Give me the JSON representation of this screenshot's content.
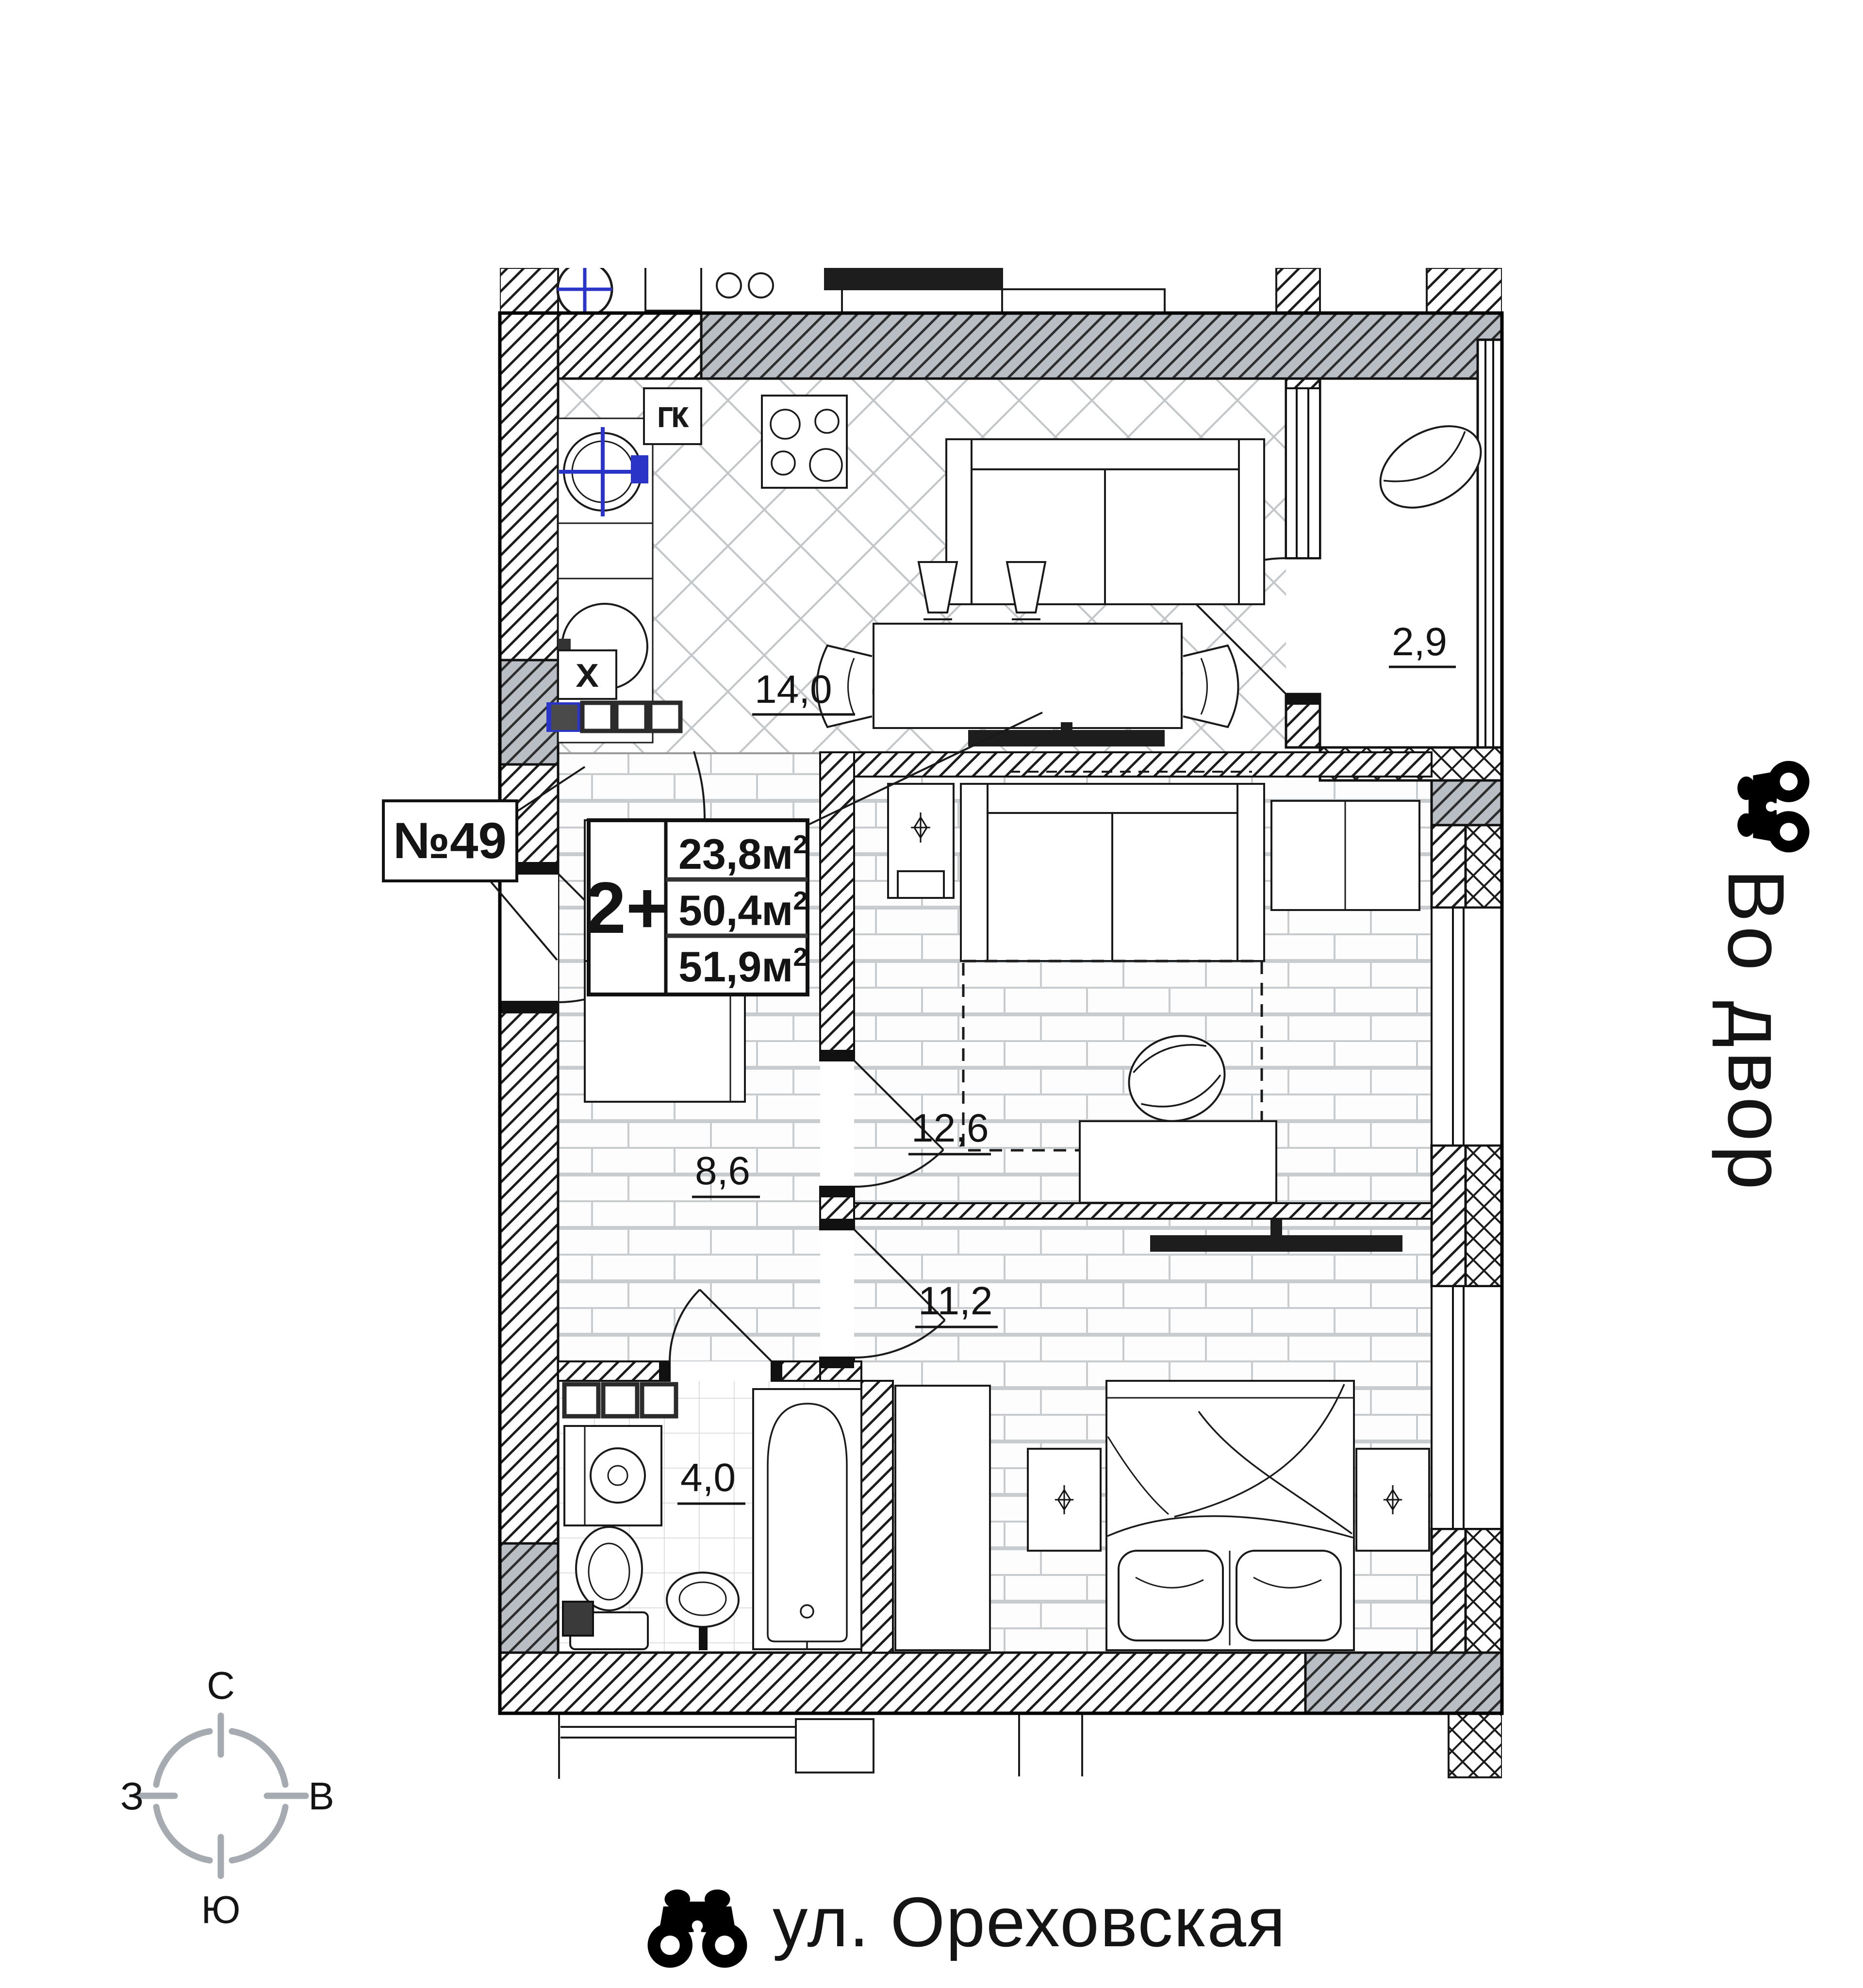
{
  "plan": {
    "apartment_number": "№49",
    "info_box": {
      "type": "2+",
      "rows": [
        {
          "area": "23,8м"
        },
        {
          "area": "50,4м"
        },
        {
          "area": "51,9м"
        }
      ],
      "sup": "2"
    },
    "rooms": {
      "kitchen_living": "14,0",
      "balcony": "2,9",
      "room": "12,6",
      "hall": "8,6",
      "bedroom": "11,2",
      "bath": "4,0"
    },
    "marks": {
      "gas_boiler": "ГК",
      "vent": "X"
    }
  },
  "compass": {
    "north": "С",
    "south": "Ю",
    "west": "З",
    "east": "В"
  },
  "annotations": {
    "courtyard": "Во двор",
    "street": "ул. Ореховская"
  },
  "colors": {
    "accent_blue": "#2a35c8",
    "wall_grey": "#b9bec4",
    "compass_grey": "#9ba1a8"
  }
}
